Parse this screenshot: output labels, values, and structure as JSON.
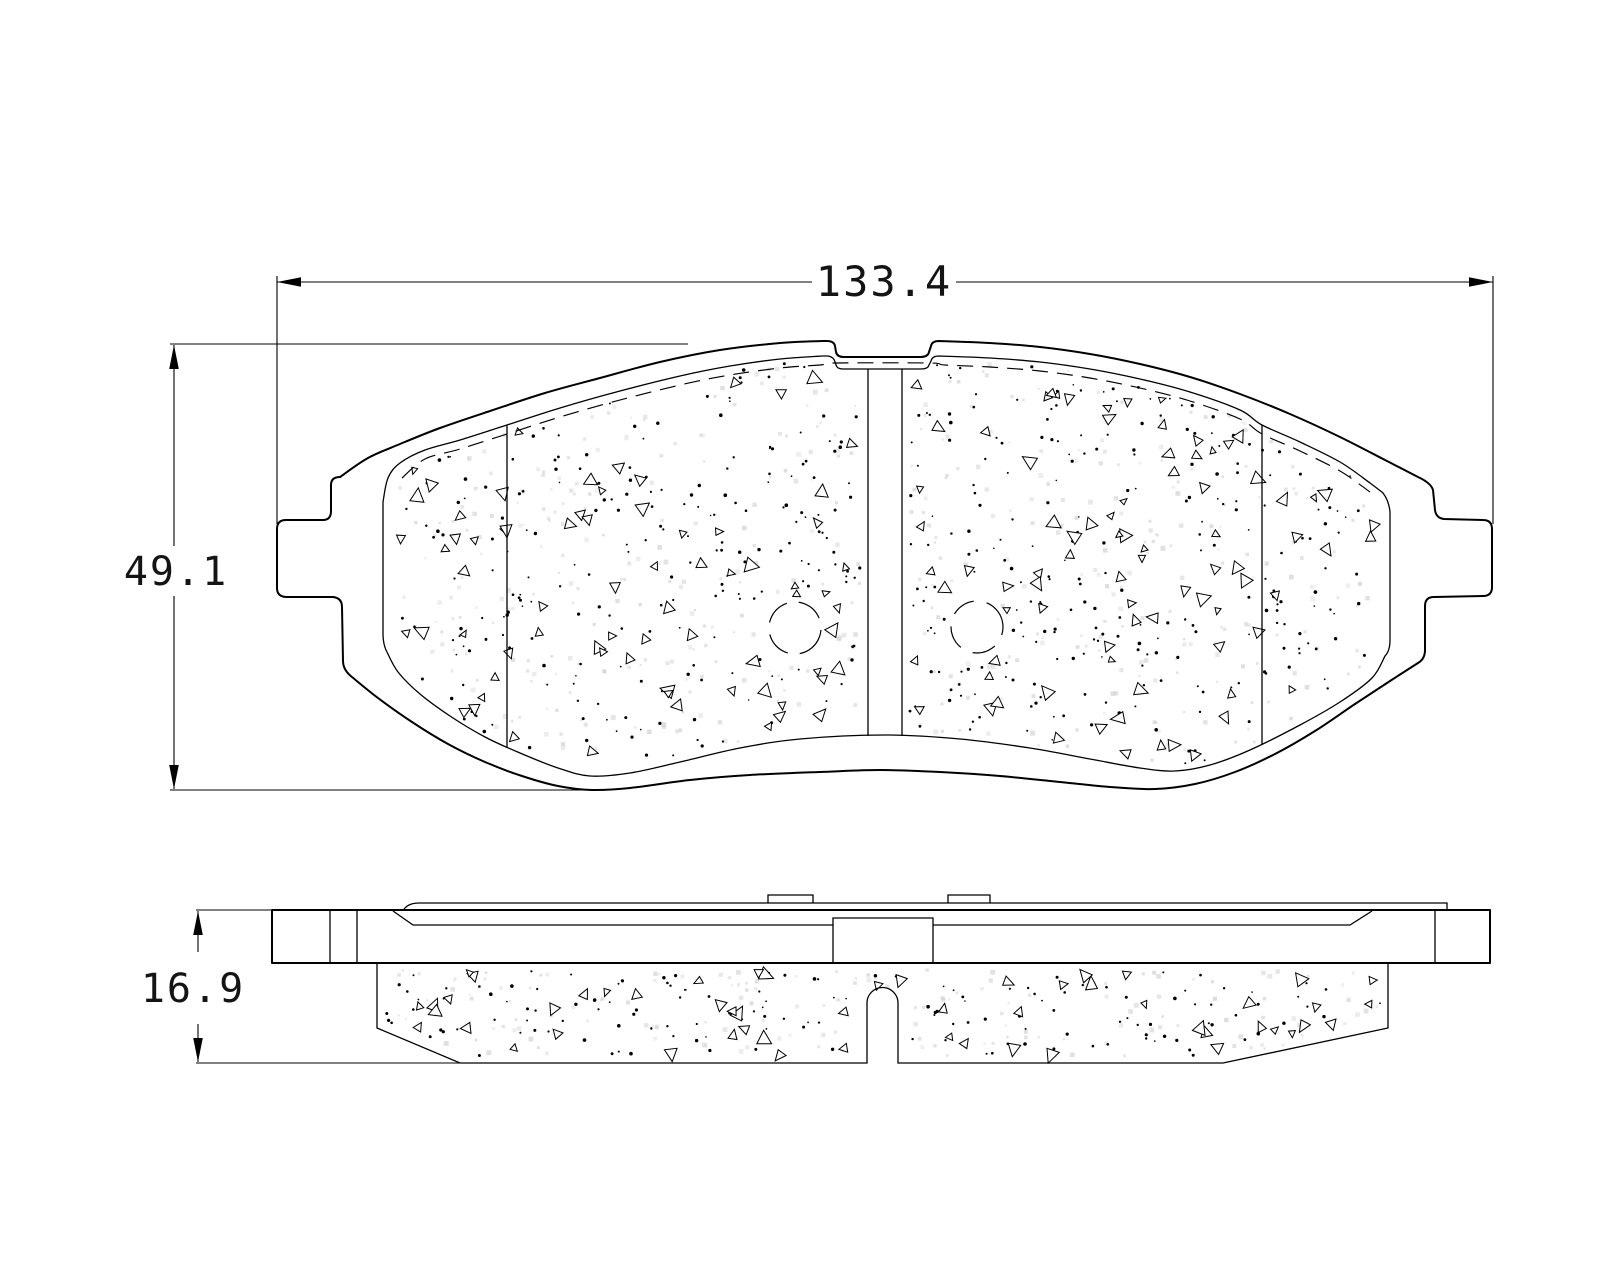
{
  "page": {
    "background": "#ffffff"
  },
  "drawing": {
    "dimensions": {
      "overall_width": "133.4",
      "overall_height": "49.1",
      "thickness": "16.9"
    },
    "colors": {
      "line": "#000000",
      "background": "#ffffff",
      "speckle_gray": "#c9c9c9"
    },
    "views": {
      "front": "brake-pad-front-view",
      "side": "brake-pad-side-view"
    }
  }
}
